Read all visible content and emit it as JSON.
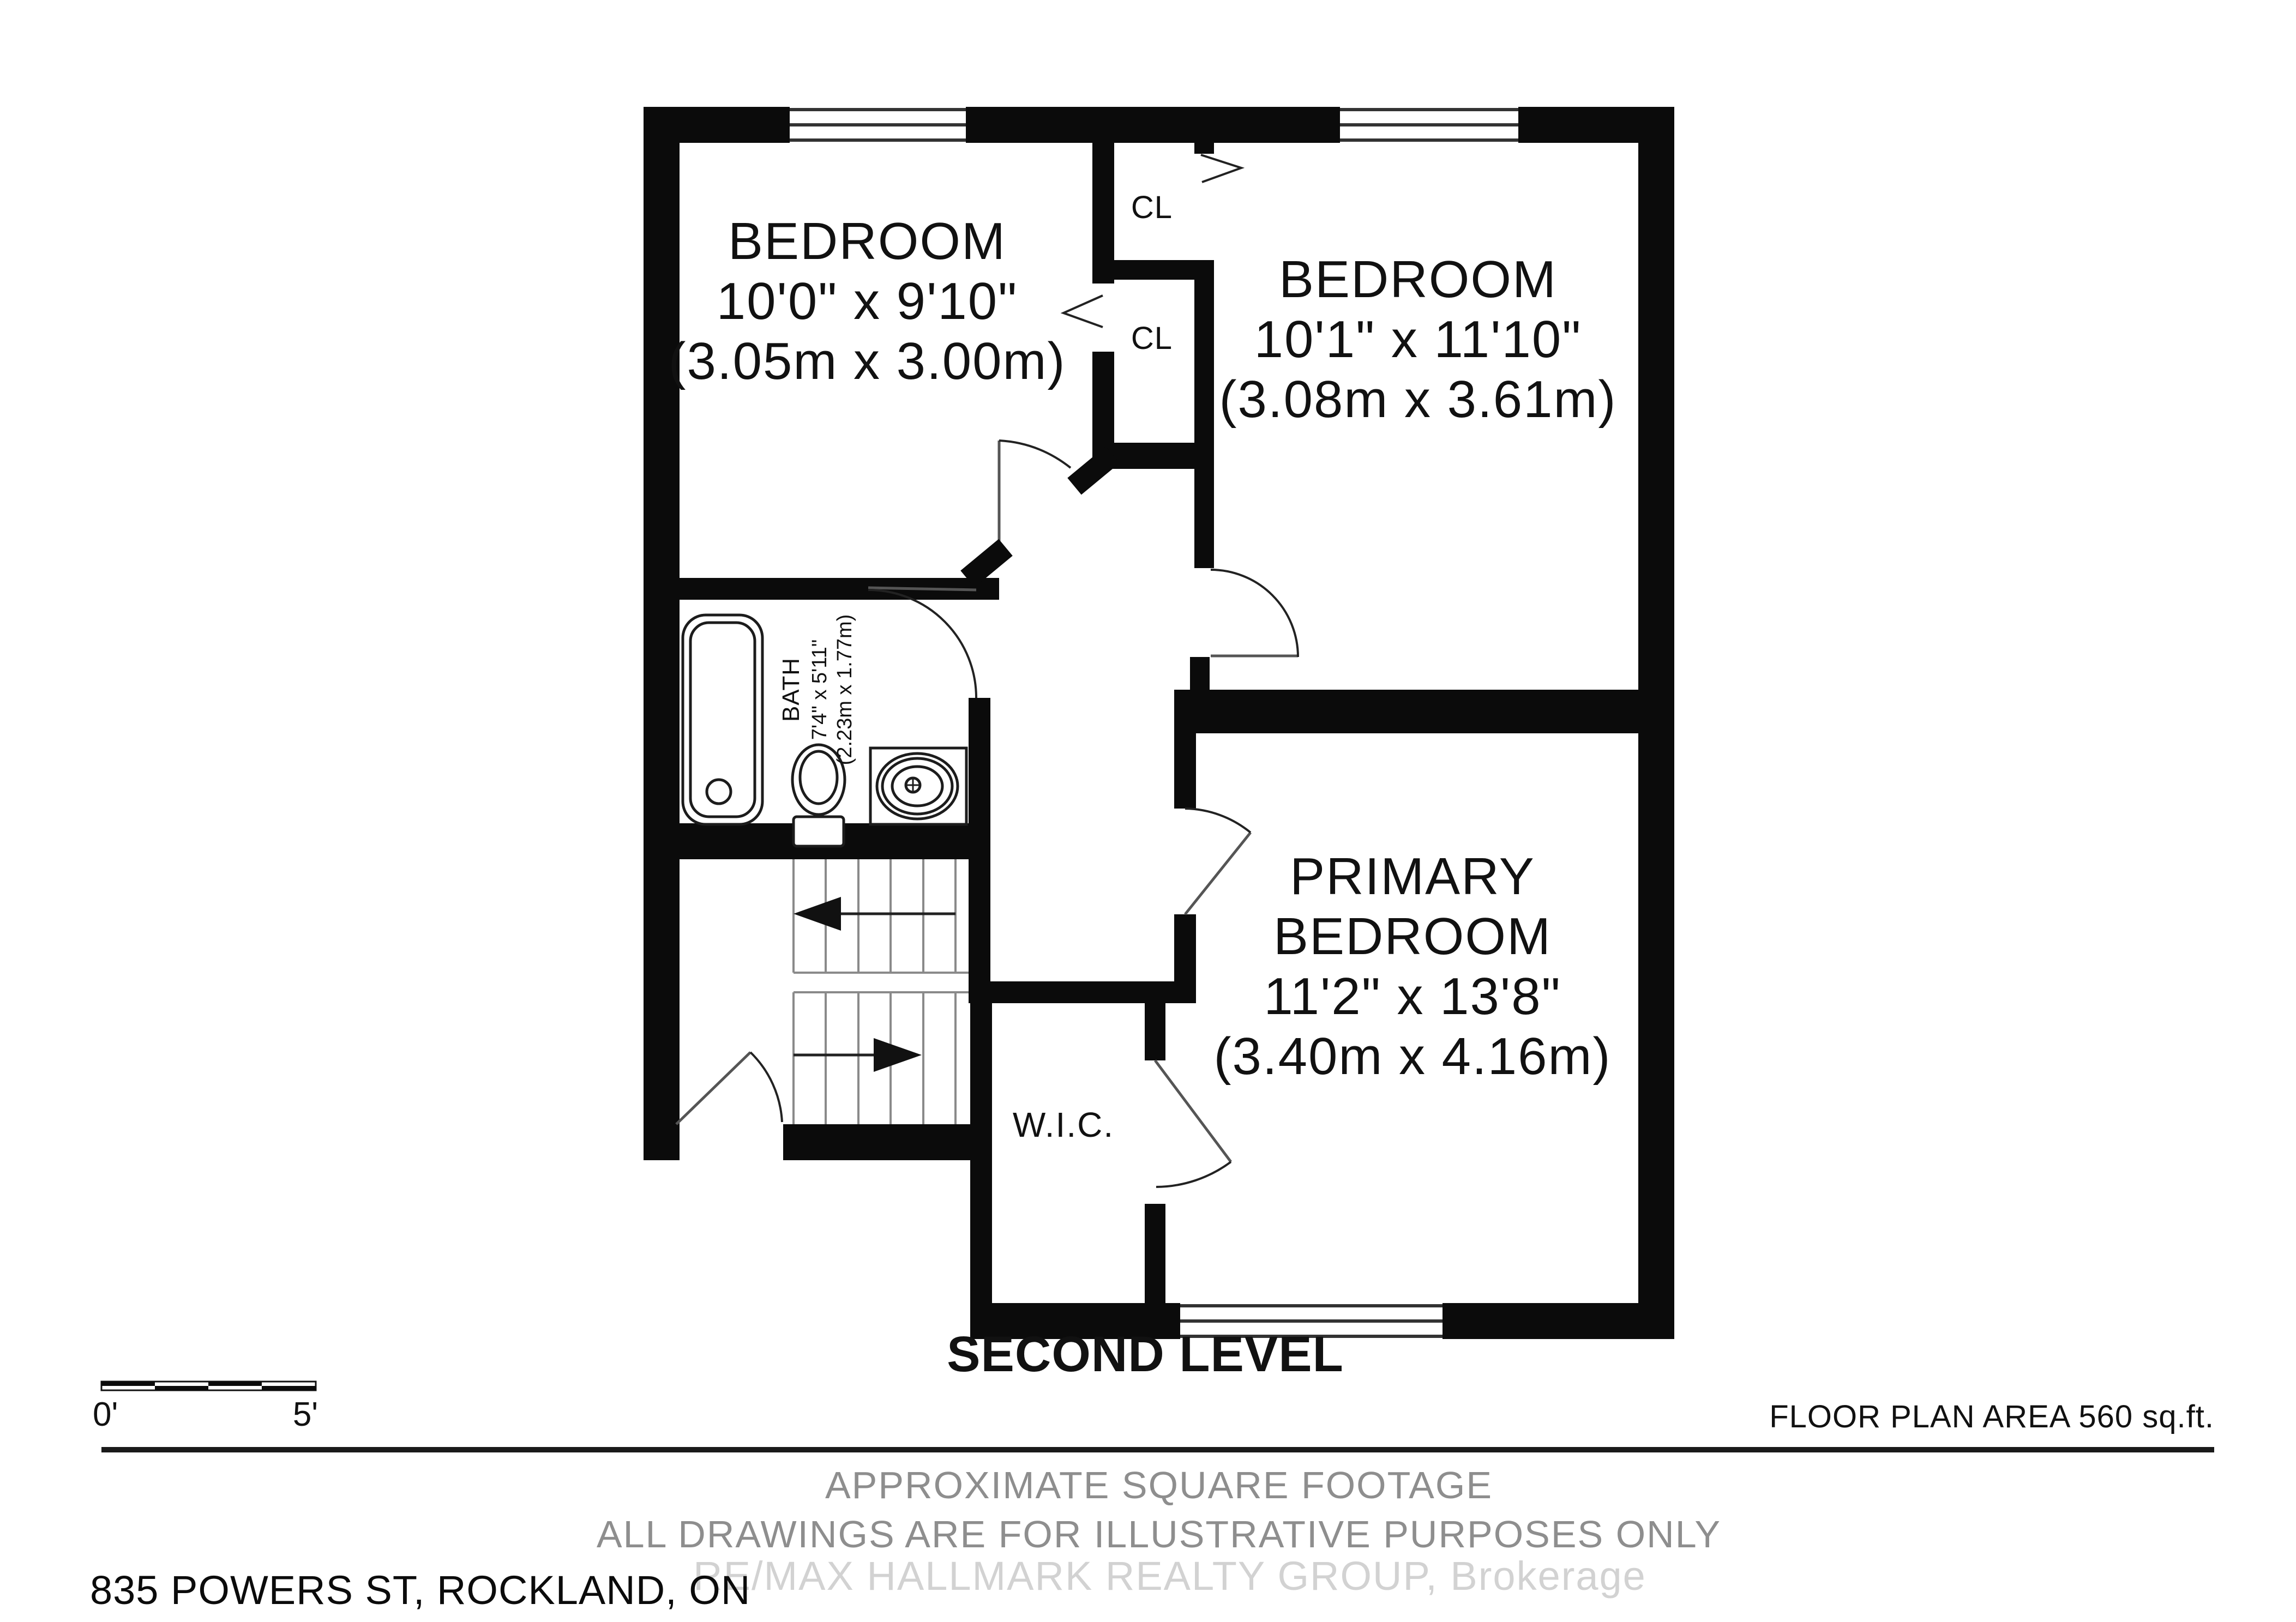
{
  "plan": {
    "level_title": "SECOND LEVEL",
    "rooms": {
      "bedroom_left": {
        "name": "BEDROOM",
        "dims": "10'0\" x 9'10\"",
        "metric": "(3.05m x 3.00m)"
      },
      "bedroom_right": {
        "name": "BEDROOM",
        "dims": "10'1\" x 11'10\"",
        "metric": "(3.08m x 3.61m)"
      },
      "primary": {
        "name_line1": "PRIMARY",
        "name_line2": "BEDROOM",
        "dims": "11'2\" x 13'8\"",
        "metric": "(3.40m x 4.16m)"
      },
      "bath": {
        "name": "BATH",
        "dims": "7'4\" x 5'11\"",
        "metric": "(2.23m x 1.77m)"
      },
      "wic": {
        "name": "W.I.C."
      },
      "closet_top": {
        "name": "CL"
      },
      "closet_bottom": {
        "name": "CL"
      }
    },
    "scale": {
      "start": "0'",
      "end": "5'"
    },
    "area_note": "FLOOR PLAN AREA 560 sq.ft.",
    "footer": {
      "line1": "APPROXIMATE SQUARE FOOTAGE",
      "line2": "ALL DRAWINGS ARE FOR ILLUSTRATIVE PURPOSES ONLY",
      "watermark": "RE/MAX HALLMARK REALTY GROUP, Brokerage",
      "address": "835 POWERS ST, ROCKLAND, ON"
    },
    "colors": {
      "wall": "#0b0b0b",
      "tread": "#8a8a8a",
      "footer_gray": "#8e8e8e",
      "watermark": "#d2d2d2"
    }
  }
}
